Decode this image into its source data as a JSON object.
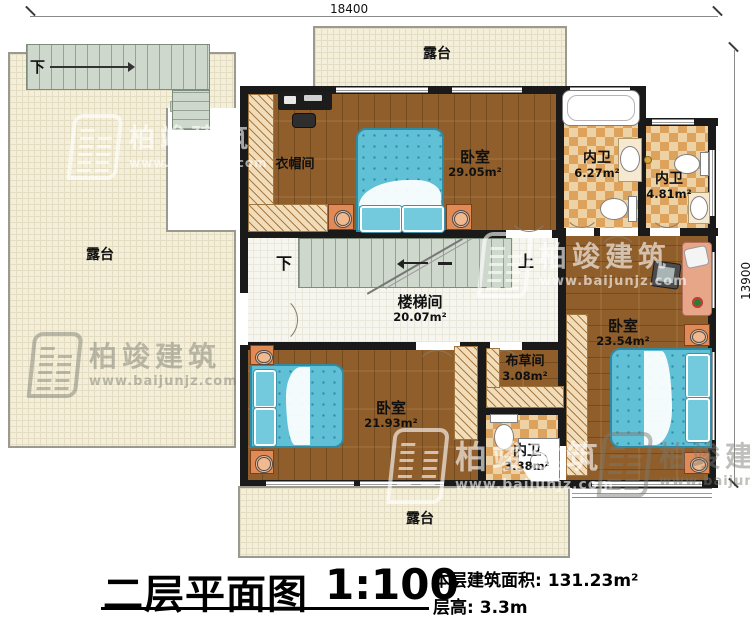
{
  "plan": {
    "dimensions": {
      "top": "18400",
      "right": "13900"
    },
    "terraces": {
      "left": "露台",
      "top": "露台",
      "bottom": "露台"
    },
    "stairs": {
      "outdoor_down": "下",
      "down": "下",
      "up": "上"
    },
    "rooms": {
      "cloakroom": {
        "name": "衣帽间"
      },
      "bedroom_top": {
        "name": "卧室",
        "area": "29.05m²"
      },
      "bath_a": {
        "name": "内卫",
        "area": "6.27m²"
      },
      "bath_b": {
        "name": "内卫",
        "area": "4.81m²"
      },
      "stairwell": {
        "name": "楼梯间",
        "area": "20.07m²"
      },
      "bedroom_right": {
        "name": "卧室",
        "area": "23.54m²"
      },
      "linen": {
        "name": "布草间",
        "area": "3.08m²"
      },
      "bath_c": {
        "name": "内卫",
        "area": "3.38m²"
      },
      "bedroom_left": {
        "name": "卧室",
        "area": "21.93m²"
      }
    }
  },
  "title_block": {
    "title": "二层平面图",
    "scale": "1:100",
    "floor_area_label": "本层建筑面积:",
    "floor_area_value": "131.23m²",
    "floor_height_label": "层高:",
    "floor_height_value": "3.3m"
  },
  "watermark": {
    "brand": "柏竣建筑",
    "url": "www.baijunjz.com"
  },
  "colors": {
    "wall": "#1a1a1a",
    "wood_floor": "#8f5e2b",
    "tile_dark": "#dda25c",
    "tile_light": "#ecd2a4",
    "terrace": "#f4efdb",
    "stair": "#cfd8cc",
    "bed": "#5fc0d6",
    "furniture_accent": "#e18a55"
  }
}
